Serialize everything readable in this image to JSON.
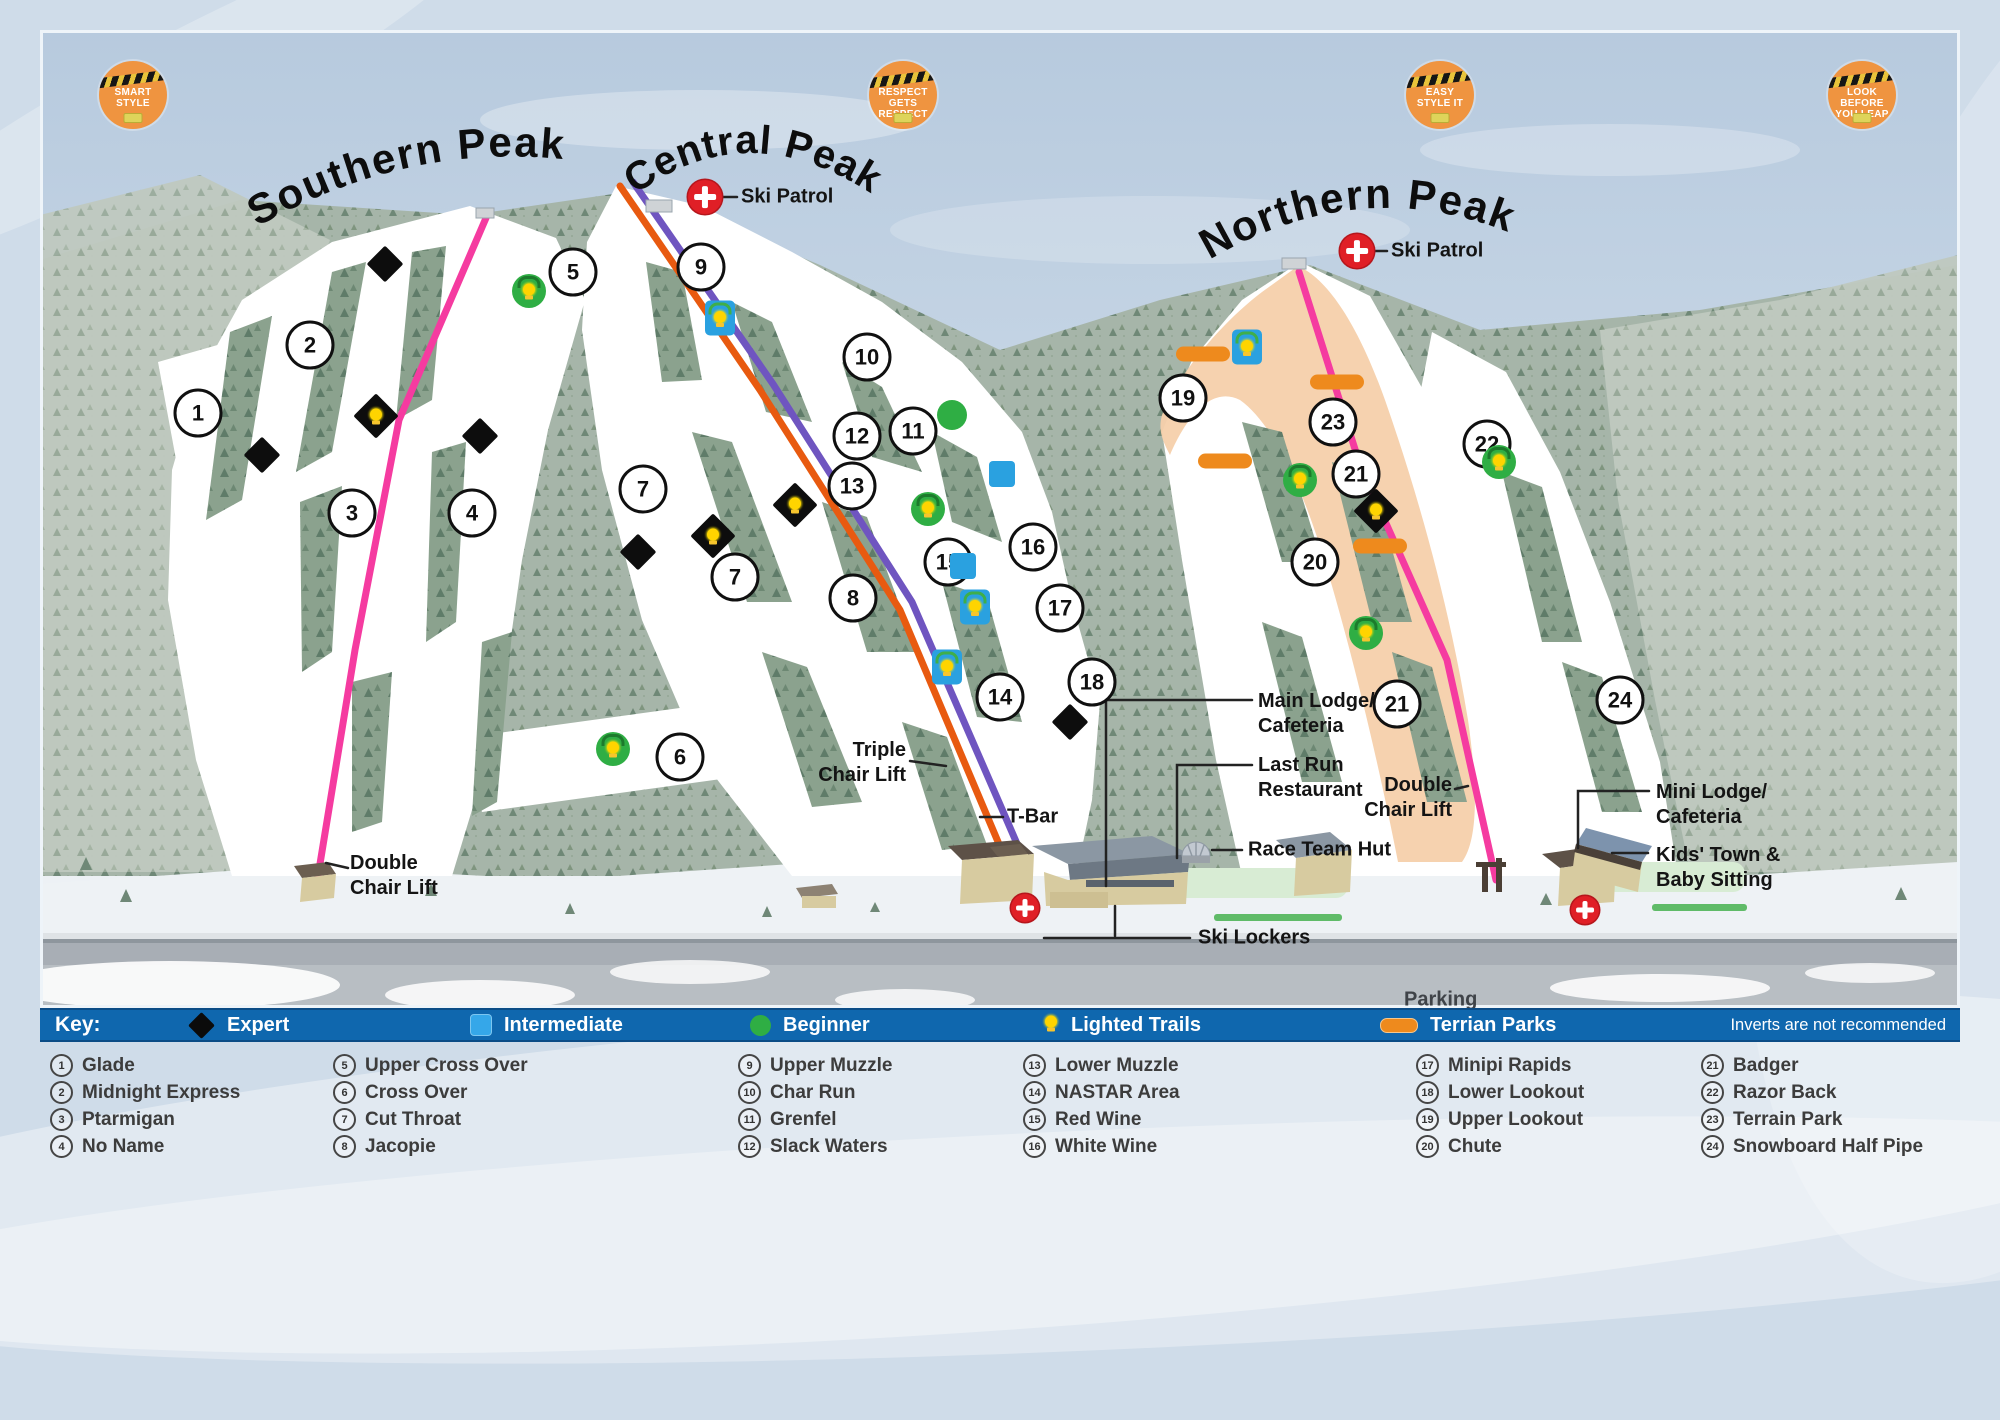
{
  "peaks": {
    "southern": "Southern Peak",
    "central": "Central Peak",
    "northern": "Northern Peak"
  },
  "badges": [
    {
      "name": "smart-style-badge",
      "lines": [
        "Smart",
        "Style"
      ],
      "x": 133,
      "y": 95
    },
    {
      "name": "respect-gets-respect-badge",
      "lines": [
        "Respect",
        "Gets Respect"
      ],
      "x": 903,
      "y": 95
    },
    {
      "name": "easy-style-it-badge",
      "lines": [
        "Easy",
        "Style It"
      ],
      "x": 1440,
      "y": 95
    },
    {
      "name": "look-before-you-leap-badge",
      "lines": [
        "Look Before",
        "You Leap"
      ],
      "x": 1862,
      "y": 95
    }
  ],
  "map_labels": [
    {
      "name": "ski-patrol-central",
      "lines": [
        "Ski Patrol"
      ],
      "x": 741,
      "y": 197,
      "align": "left"
    },
    {
      "name": "ski-patrol-northern",
      "lines": [
        "Ski Patrol"
      ],
      "x": 1391,
      "y": 251,
      "align": "left"
    },
    {
      "name": "triple-chair-lift",
      "lines": [
        "Triple",
        "Chair Lift"
      ],
      "x": 906,
      "y": 763,
      "align": "right"
    },
    {
      "name": "t-bar",
      "lines": [
        "T-Bar"
      ],
      "x": 1007,
      "y": 817,
      "align": "left"
    },
    {
      "name": "double-chair-lift-south",
      "lines": [
        "Double",
        "Chair Lift"
      ],
      "x": 350,
      "y": 876,
      "align": "left"
    },
    {
      "name": "main-lodge",
      "lines": [
        "Main Lodge/",
        "Cafeteria"
      ],
      "x": 1258,
      "y": 714,
      "align": "left"
    },
    {
      "name": "last-run-restaurant",
      "lines": [
        "Last Run",
        "Restaurant"
      ],
      "x": 1258,
      "y": 778,
      "align": "left"
    },
    {
      "name": "race-team-hut",
      "lines": [
        "Race Team Hut"
      ],
      "x": 1248,
      "y": 850,
      "align": "left"
    },
    {
      "name": "ski-lockers",
      "lines": [
        "Ski Lockers"
      ],
      "x": 1198,
      "y": 938,
      "align": "left"
    },
    {
      "name": "double-chair-lift-north",
      "lines": [
        "Double",
        "Chair Lift"
      ],
      "x": 1452,
      "y": 798,
      "align": "right"
    },
    {
      "name": "mini-lodge",
      "lines": [
        "Mini Lodge/",
        "Cafeteria"
      ],
      "x": 1656,
      "y": 805,
      "align": "left"
    },
    {
      "name": "kids-town",
      "lines": [
        "Kids' Town &",
        "Baby Sitting"
      ],
      "x": 1656,
      "y": 868,
      "align": "left"
    },
    {
      "name": "parking",
      "lines": [
        "Parking"
      ],
      "x": 1404,
      "y": 1000,
      "align": "left",
      "cls": "plain"
    }
  ],
  "markers": {
    "circles": [
      {
        "n": "1",
        "x": 198,
        "y": 413
      },
      {
        "n": "2",
        "x": 310,
        "y": 345
      },
      {
        "n": "3",
        "x": 352,
        "y": 513
      },
      {
        "n": "4",
        "x": 472,
        "y": 513
      },
      {
        "n": "5",
        "x": 573,
        "y": 272
      },
      {
        "n": "6",
        "x": 680,
        "y": 757
      },
      {
        "n": "7",
        "x": 643,
        "y": 489
      },
      {
        "n": "7",
        "x": 735,
        "y": 577
      },
      {
        "n": "8",
        "x": 853,
        "y": 598
      },
      {
        "n": "9",
        "x": 701,
        "y": 267
      },
      {
        "n": "10",
        "x": 867,
        "y": 357
      },
      {
        "n": "11",
        "x": 913,
        "y": 431
      },
      {
        "n": "12",
        "x": 857,
        "y": 436
      },
      {
        "n": "13",
        "x": 852,
        "y": 486
      },
      {
        "n": "14",
        "x": 1000,
        "y": 697
      },
      {
        "n": "15",
        "x": 948,
        "y": 562
      },
      {
        "n": "16",
        "x": 1033,
        "y": 547
      },
      {
        "n": "17",
        "x": 1060,
        "y": 608
      },
      {
        "n": "18",
        "x": 1092,
        "y": 682
      },
      {
        "n": "19",
        "x": 1183,
        "y": 398
      },
      {
        "n": "20",
        "x": 1315,
        "y": 562
      },
      {
        "n": "21",
        "x": 1356,
        "y": 474
      },
      {
        "n": "21",
        "x": 1397,
        "y": 704
      },
      {
        "n": "22",
        "x": 1487,
        "y": 444
      },
      {
        "n": "23",
        "x": 1333,
        "y": 422
      },
      {
        "n": "24",
        "x": 1620,
        "y": 700
      }
    ],
    "expert": [
      {
        "x": 385,
        "y": 264
      },
      {
        "x": 262,
        "y": 455
      },
      {
        "x": 480,
        "y": 436
      },
      {
        "x": 638,
        "y": 552
      },
      {
        "x": 1070,
        "y": 722
      }
    ],
    "expert_lit": [
      {
        "x": 376,
        "y": 416
      },
      {
        "x": 713,
        "y": 536
      },
      {
        "x": 795,
        "y": 505
      },
      {
        "x": 1376,
        "y": 511
      }
    ],
    "intermediate": [
      {
        "x": 1002,
        "y": 474
      },
      {
        "x": 963,
        "y": 566
      }
    ],
    "intermediate_lit": [
      {
        "x": 720,
        "y": 318
      },
      {
        "x": 975,
        "y": 607
      },
      {
        "x": 947,
        "y": 667
      },
      {
        "x": 1247,
        "y": 347
      }
    ],
    "beginner": [
      {
        "x": 952,
        "y": 415
      }
    ],
    "beginner_lit": [
      {
        "x": 529,
        "y": 291
      },
      {
        "x": 613,
        "y": 749
      },
      {
        "x": 928,
        "y": 509
      },
      {
        "x": 1300,
        "y": 480
      },
      {
        "x": 1499,
        "y": 462
      },
      {
        "x": 1366,
        "y": 633
      }
    ],
    "parks": [
      {
        "x": 1203,
        "y": 354
      },
      {
        "x": 1337,
        "y": 382
      },
      {
        "x": 1225,
        "y": 461
      },
      {
        "x": 1380,
        "y": 546
      }
    ],
    "patrol": [
      {
        "x": 705,
        "y": 197,
        "s": 34
      },
      {
        "x": 1357,
        "y": 251,
        "s": 34
      },
      {
        "x": 1025,
        "y": 908,
        "s": 28
      },
      {
        "x": 1585,
        "y": 910,
        "s": 28
      }
    ]
  },
  "legend": {
    "key_label": "Key:",
    "items": [
      {
        "type": "expert",
        "label": "Expert",
        "x": 148
      },
      {
        "type": "intermediate",
        "label": "Intermediate",
        "x": 430
      },
      {
        "type": "beginner",
        "label": "Beginner",
        "x": 710
      },
      {
        "type": "lighted",
        "label": "Lighted Trails",
        "x": 1003
      },
      {
        "type": "park",
        "label": "Terrian Parks",
        "x": 1340
      }
    ],
    "note": "Inverts are not recommended"
  },
  "trail_list": {
    "columns": [
      [
        {
          "n": "1",
          "name": "Glade"
        },
        {
          "n": "2",
          "name": "Midnight Express"
        },
        {
          "n": "3",
          "name": "Ptarmigan"
        },
        {
          "n": "4",
          "name": "No Name"
        }
      ],
      [
        {
          "n": "5",
          "name": "Upper Cross Over"
        },
        {
          "n": "6",
          "name": "Cross Over"
        },
        {
          "n": "7",
          "name": "Cut Throat"
        },
        {
          "n": "8",
          "name": "Jacopie"
        }
      ],
      [
        {
          "n": "9",
          "name": "Upper Muzzle"
        },
        {
          "n": "10",
          "name": "Char Run"
        },
        {
          "n": "11",
          "name": "Grenfel"
        },
        {
          "n": "12",
          "name": "Slack Waters"
        }
      ],
      [
        {
          "n": "13",
          "name": "Lower Muzzle"
        },
        {
          "n": "14",
          "name": "NASTAR Area"
        },
        {
          "n": "15",
          "name": "Red Wine"
        },
        {
          "n": "16",
          "name": "White Wine"
        }
      ],
      [
        {
          "n": "17",
          "name": "Minipi Rapids"
        },
        {
          "n": "18",
          "name": "Lower Lookout"
        },
        {
          "n": "19",
          "name": "Upper Lookout"
        },
        {
          "n": "20",
          "name": "Chute"
        }
      ],
      [
        {
          "n": "21",
          "name": "Badger"
        },
        {
          "n": "22",
          "name": "Razor Back"
        },
        {
          "n": "23",
          "name": "Terrain Park"
        },
        {
          "n": "24",
          "name": "Snowboard Half Pipe"
        }
      ]
    ]
  },
  "colors": {
    "legend_bar_blue": "#0f67ae",
    "pink_lift": "#f53ba0",
    "orange_lift": "#e85a10",
    "purple_lift": "#6f55c0",
    "terrain_park_orange": "#ee8a1d",
    "intermediate_blue": "#2aa1e0",
    "beginner_green": "#2fae44",
    "patrol_red": "#e01f26"
  }
}
